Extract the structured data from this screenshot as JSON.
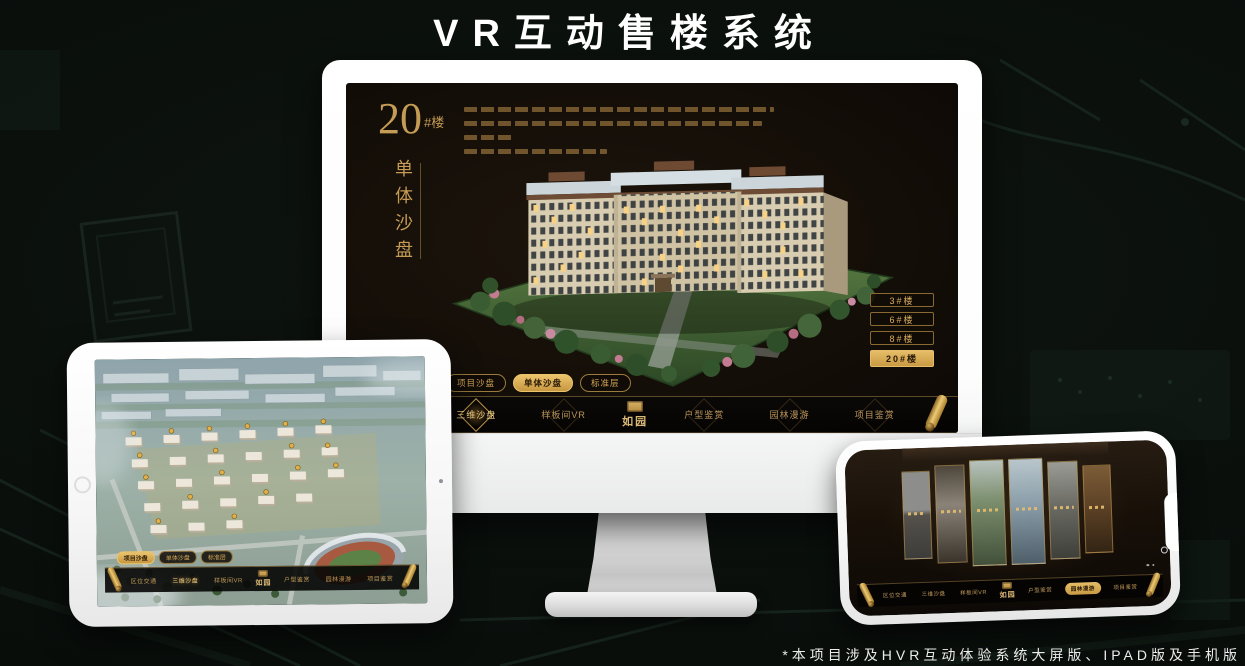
{
  "title": "VR互动售楼系统",
  "footnote": "*本项目涉及HVR互动体验系统大屏版、IPAD版及手机版",
  "colors": {
    "accent_gold": "#c9a15e",
    "selected_gold": "#d9ae5c",
    "screen_background": "#14100a",
    "page_background": "#0a0f0c"
  },
  "app": {
    "logo_name": "如园",
    "nav_items": [
      {
        "label": "区位交通"
      },
      {
        "label": "三维沙盘"
      },
      {
        "label": "样板间VR"
      },
      {
        "label": "户型鉴赏"
      },
      {
        "label": "园林漫游"
      },
      {
        "label": "项目鉴赏"
      }
    ],
    "sub_tabs": [
      {
        "label": "项目沙盘"
      },
      {
        "label": "单体沙盘"
      },
      {
        "label": "标准层"
      }
    ]
  },
  "monitor_screen": {
    "block_number": "20",
    "block_unit": "#楼",
    "block_name": "单体沙盘",
    "floor_buttons": [
      {
        "label": "3#楼"
      },
      {
        "label": "6#楼"
      },
      {
        "label": "8#楼"
      },
      {
        "label": "20#楼"
      }
    ]
  }
}
